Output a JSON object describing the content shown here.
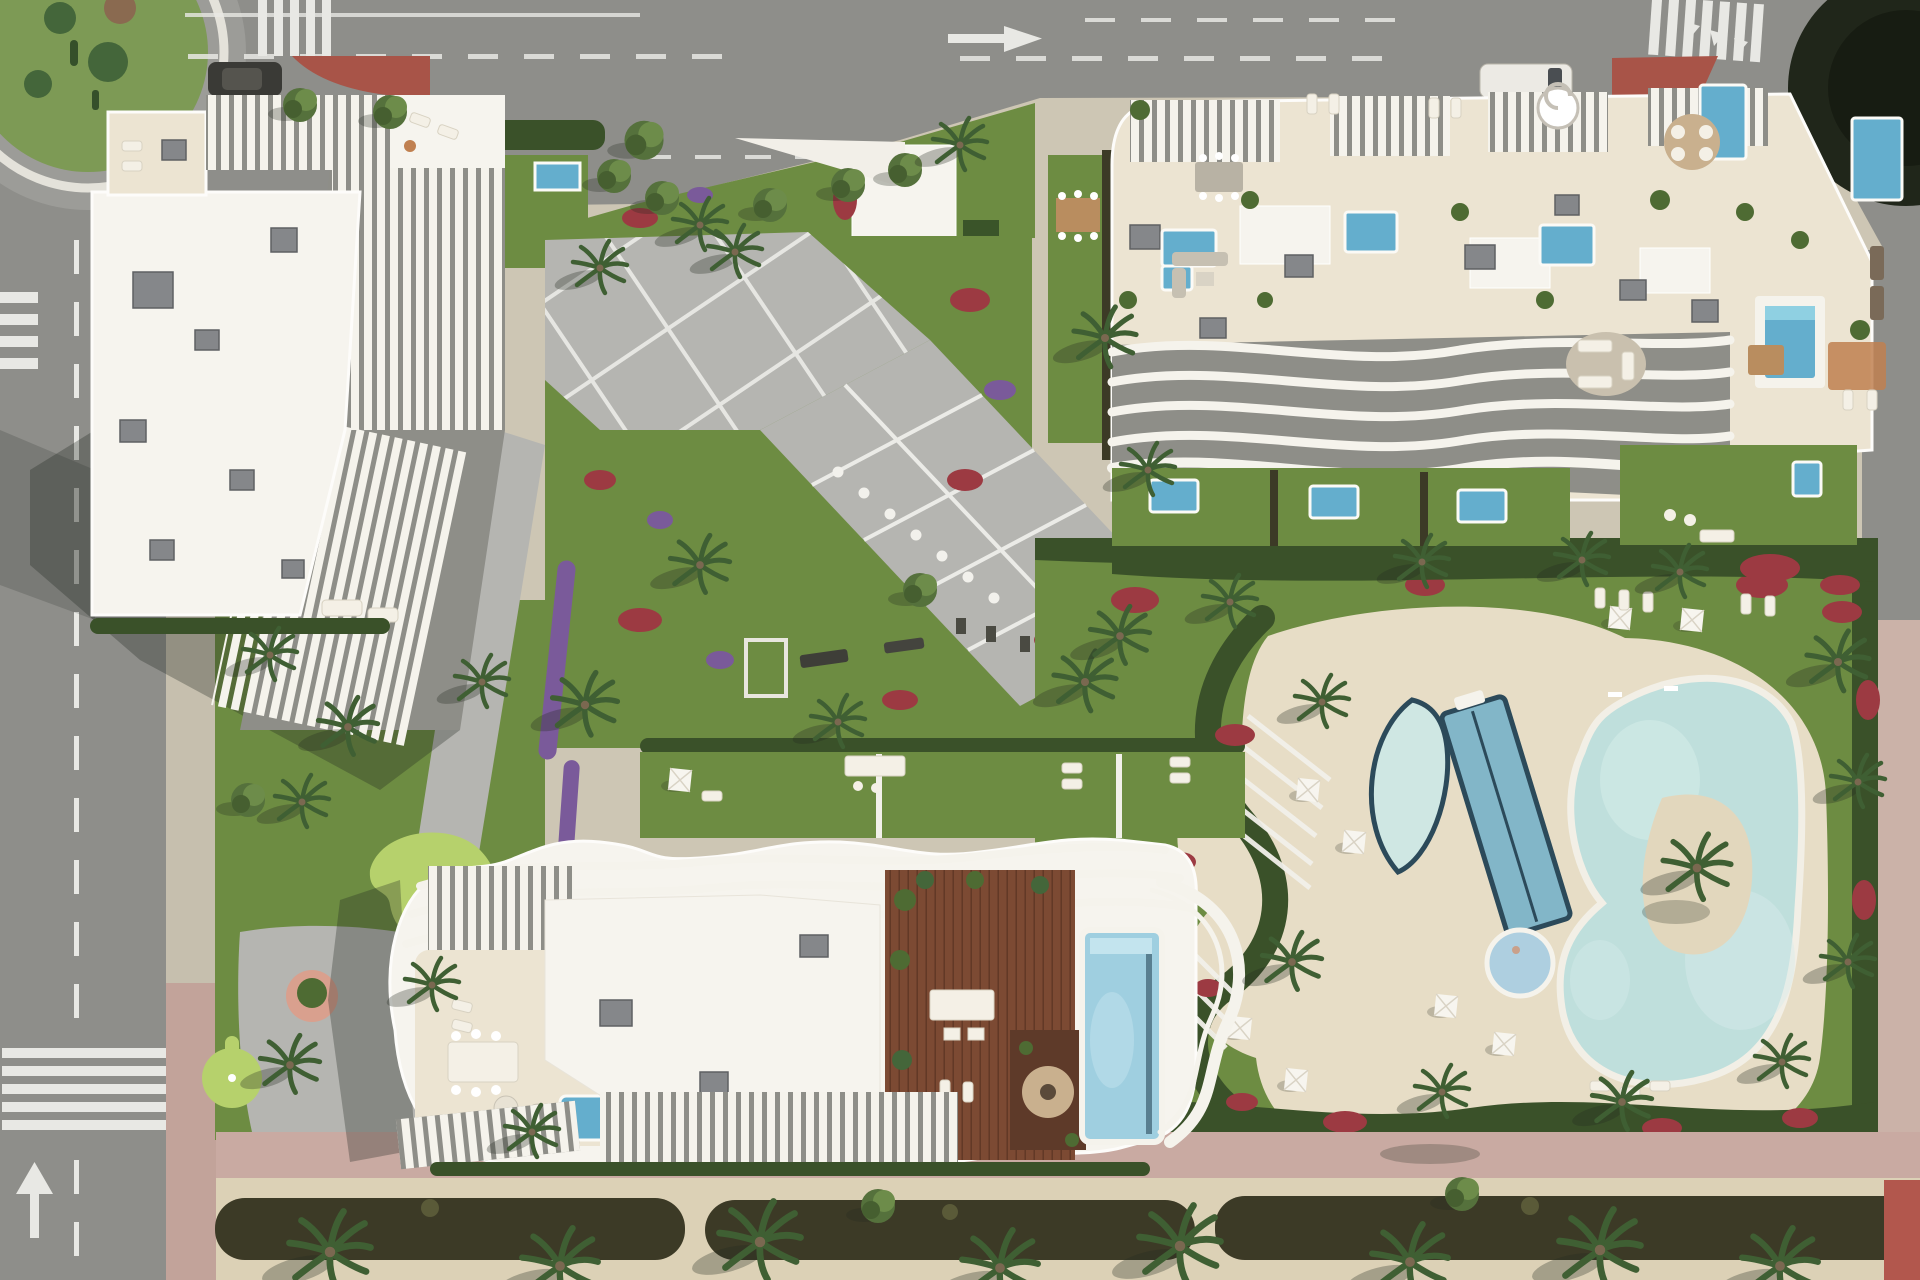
{
  "meta": {
    "type": "aerial-architectural-render",
    "description": "Top-down 3D render of a residential resort complex: three white apartment buildings with sculptural curved balcony fins, central paved plaza with diagonal walkway, lagoon-style pool with palm island, lap pool, crescent pool and round jacuzzi, mini-golf garden, rooftop pool and wooden deck, surrounded by asphalt roads, a roundabout and a bottom promenade."
  },
  "names": {
    "scene": "Aerial render of residential complex",
    "top_road": "Top asphalt road",
    "left_road": "Left asphalt road",
    "roundabout": "Roundabout with cacti planting",
    "crosswalk": "Pedestrian crosswalk",
    "building_a": "North-west building with curved balcony fins",
    "building_b": "North-east building with roof terraces",
    "building_c": "South building with rooftop pool and deck",
    "plaza": "Central paved plaza",
    "boulevard": "Diagonal walkway",
    "fitness": "Outdoor fitness lawn",
    "mini_golf": "Mini golf garden",
    "pool_deck": "Pool sun deck",
    "lagoon_pool": "Lagoon pool",
    "lap_pool": "Lap pool",
    "crescent_pool": "Crescent pool",
    "jacuzzi": "Round jacuzzi",
    "island": "Palm island",
    "rooftop_pool": "Rooftop pool",
    "wood_deck": "Rooftop wooden deck",
    "fire_platform": "Fire-pit lounge platform",
    "promenade": "Bottom promenade with hedge",
    "gardens": "Landscaped gardens",
    "van": "Parked white van",
    "car": "Parked dark car"
  },
  "colors": {
    "asphalt": "#8e8e8a",
    "road_mark": "#e8e8e4",
    "parcel": "#cdc6b4",
    "sidewalk": "#c6bfae",
    "pink_paving": "#c9aaa2",
    "sand": "#dcd1b6",
    "lawn": "#6d8c42",
    "lawn_dark": "#5d7a38",
    "minigolf_light": "#b6d16c",
    "hedge": "#3a5129",
    "hedge_dark": "#3c3a26",
    "palm": "#3f5f33",
    "tree": "#55713c",
    "tree_light": "#6d8c4a",
    "tree_dark2": "#465f30",
    "flower_red": "#9c3a42",
    "flower_purple": "#7a5a9a",
    "paving": "#b5b5b1",
    "paving_line": "#ebebe7",
    "deck_cream": "#e7ddc6",
    "terrace_floor": "#ece4d2",
    "building_white": "#f6f4ee",
    "white_struct": "#f5f3ec",
    "fin_gap": "#8e8e88",
    "roof_box": "#85878a",
    "roof_box_dark": "#5e6063",
    "wood_deck": "#7c4a33",
    "wood_dark": "#5e3a29",
    "rug_tan": "#c9b08e",
    "furniture_beige": "#f4f0e6",
    "pool_bright": "#64aecd",
    "pool_water": "#9fcfe0",
    "lagoon": "#bfdfdc",
    "lagoon_light": "#d6ecea",
    "lap_pool": "#82b6c8",
    "pool_rim_dark": "#2c4a5a",
    "jacuzzi": "#aecfe0",
    "red_plaza": "#a85448",
    "roundabout_green": "#7d9a55",
    "canopy_dark": "#20261a",
    "shadow": "rgba(30,36,30,0.30)"
  }
}
